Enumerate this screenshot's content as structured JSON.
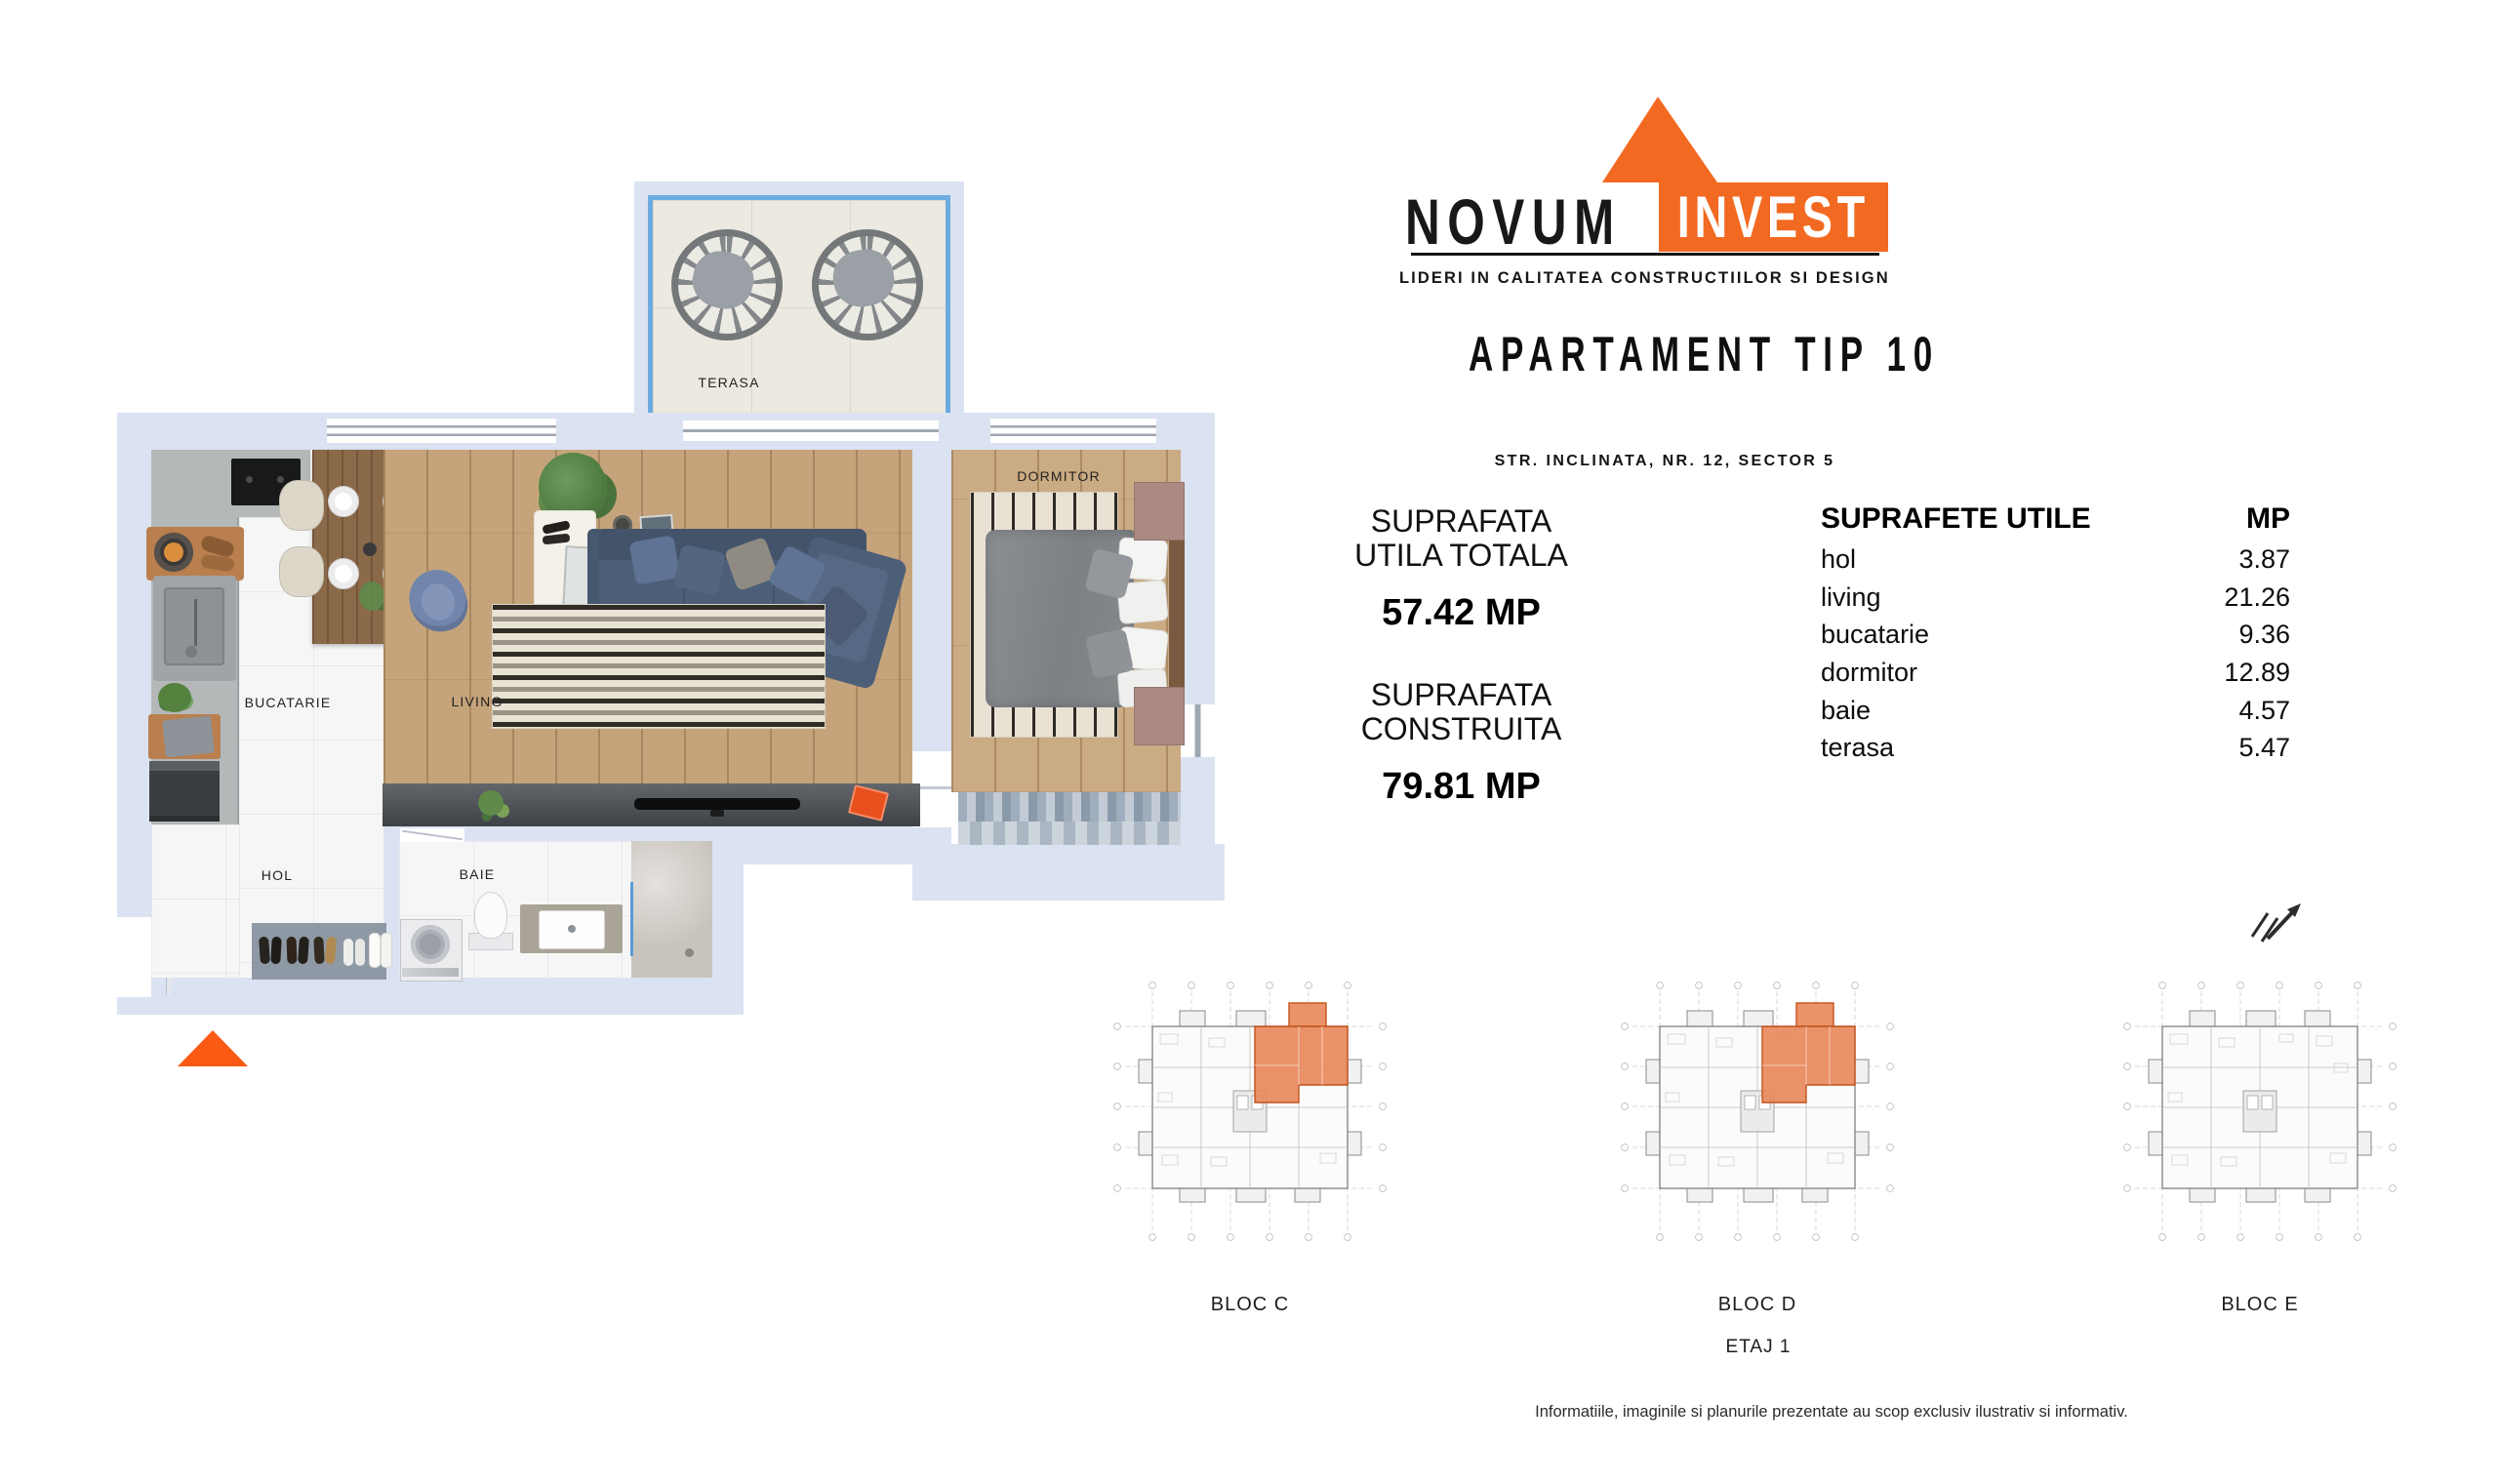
{
  "brand": {
    "name_black": "NOVUM",
    "name_white": "INVEST",
    "tagline": "LIDERI IN CALITATEA CONSTRUCTIILOR SI DESIGN"
  },
  "header": {
    "title": "APARTAMENT TIP 10",
    "address": "STR. INCLINATA, NR. 12, SECTOR 5"
  },
  "summary": {
    "utila": {
      "line1": "SUPRAFATA",
      "line2": "UTILA TOTALA",
      "value": "57.42 MP"
    },
    "construita": {
      "line1": "SUPRAFATA",
      "line2": "CONSTRUITA",
      "value": "79.81 MP"
    }
  },
  "areas_table": {
    "title": "SUPRAFETE UTILE",
    "unit": "MP",
    "rows": [
      {
        "name": "hol",
        "value": "3.87"
      },
      {
        "name": "living",
        "value": "21.26"
      },
      {
        "name": "bucatarie",
        "value": "9.36"
      },
      {
        "name": "dormitor",
        "value": "12.89"
      },
      {
        "name": "baie",
        "value": "4.57"
      },
      {
        "name": "terasa",
        "value": "5.47"
      }
    ]
  },
  "floor_plan": {
    "labels": {
      "terasa": "TERASA",
      "dormitor": "DORMITOR",
      "bucatarie": "BUCATARIE",
      "living": "LIVING",
      "hol": "HOL",
      "baie": "BAIE"
    }
  },
  "blocks": [
    {
      "label": "BLOC C",
      "highlighted": true
    },
    {
      "label": "BLOC D",
      "highlighted": true
    },
    {
      "label": "BLOC E",
      "highlighted": false
    }
  ],
  "floor_label": "ETAJ 1",
  "disclaimer": "Informatiile, imaginile si planurile prezentate au scop exclusiv ilustrativ si informativ.",
  "colors": {
    "brand_orange": "#F26A21",
    "highlight_fill": "#E8895C",
    "highlight_stroke": "#C4531B",
    "marker_orange": "#FB5A15",
    "wall_lavender": "#DBE2F1",
    "terasa_rail_blue": "#6CABDF"
  }
}
